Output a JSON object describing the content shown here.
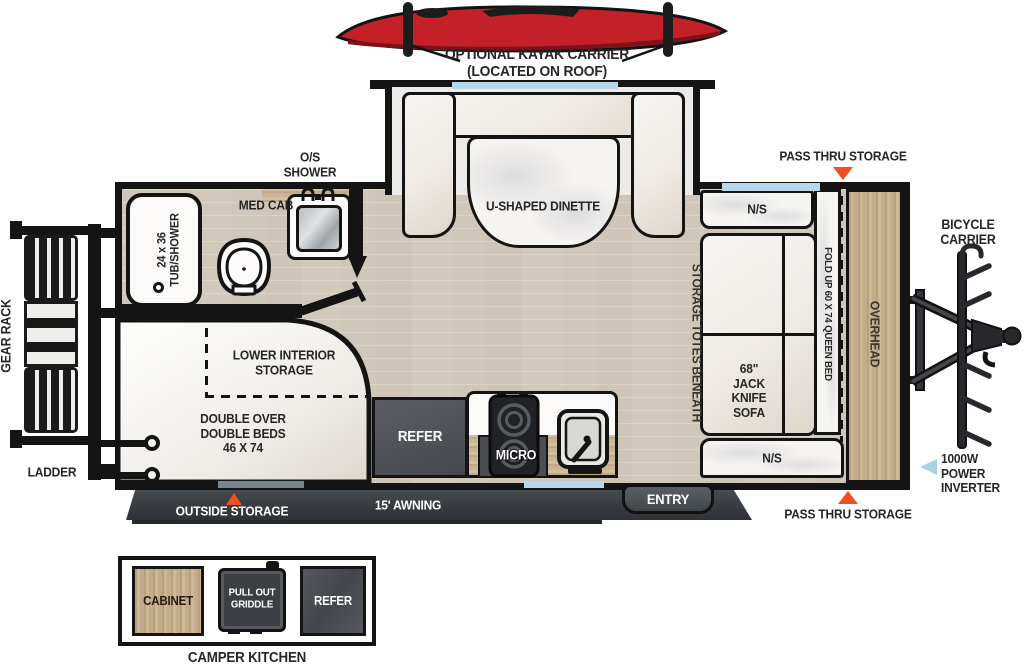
{
  "colors": {
    "wall": "#141414",
    "accent_orange": "#F04E23",
    "arrow_blue": "#AED0E6",
    "kayak_red": "#C32127",
    "window_blue": "#B7D8EC"
  },
  "kayak": {
    "label": "OPTIONAL KAYAK CARRIER\n(LOCATED ON ROOF)"
  },
  "exterior": {
    "gear_rack": "GEAR RACK",
    "ladder": "LADDER",
    "pass_thru_top": "PASS THRU STORAGE",
    "pass_thru_bottom": "PASS THRU STORAGE",
    "bicycle_carrier": "BICYCLE\nCARRIER",
    "power_inverter": "1000W\nPOWER\nINVERTER",
    "outside_storage": "OUTSIDE STORAGE",
    "awning": "15' AWNING",
    "entry": "ENTRY"
  },
  "interior": {
    "dinette": "U-SHAPED DINETTE",
    "os_shower": "O/S\nSHOWER",
    "med_cab": "MED CAB",
    "tub_shower": "24 x 36\nTUB/SHOWER",
    "lower_storage": "LOWER INTERIOR\nSTORAGE",
    "double_beds": "DOUBLE OVER\nDOUBLE BEDS\n46 X 74",
    "refer": "REFER",
    "micro": "MICRO",
    "storage_totes": "STORAGE TOTES BENEATH",
    "ns_top": "N/S",
    "ns_bottom": "N/S",
    "jack_knife_sofa": "68\"\nJACK\nKNIFE\nSOFA",
    "queen_bed": "FOLD UP 60 X 74 QUEEN BED",
    "overhead": "OVERHEAD"
  },
  "camper_kitchen": {
    "title": "CAMPER KITCHEN",
    "cabinet": "CABINET",
    "griddle": "PULL OUT\nGRIDDLE",
    "refer": "REFER"
  }
}
